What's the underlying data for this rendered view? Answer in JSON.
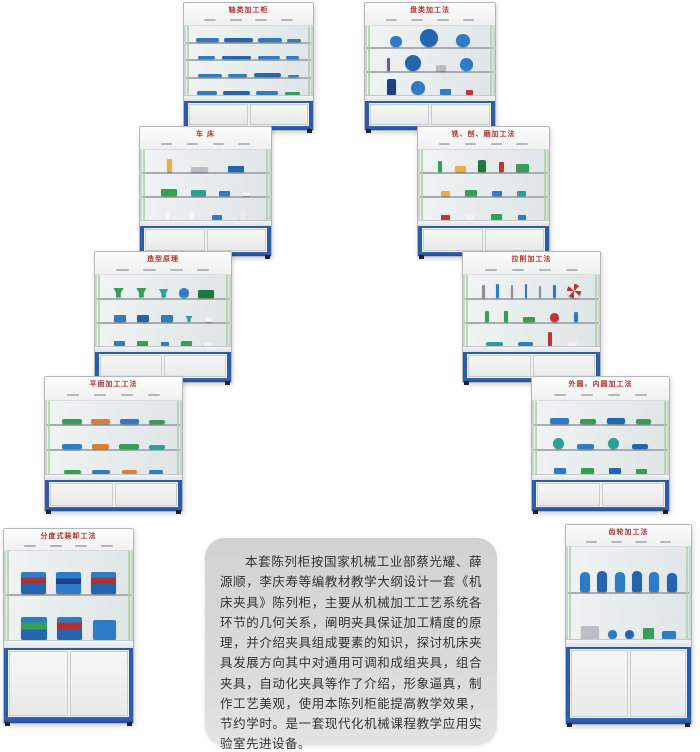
{
  "colors": {
    "frame_blue": "#2a5caa",
    "title_red": "#b23030",
    "seal_green": "#a9d3a4",
    "item_blue": "#2e7cc8",
    "item_green": "#33a055",
    "panel_gray": "#d8d8d8"
  },
  "panel": {
    "text": "本套陈列柜按国家机械工业部蔡光耀、薛源顺，李庆寿等编教材教学大纲设计一套《机床夹具》陈列柜，主要从机械加工工艺系统各环节的几何关系，阐明夹具保证加工精度的原理，并介绍夹具组成要素的知识，探讨机床夹具发展方向其中对通用可调和成组夹具，组合夹具，自动化夹具等作了介绍，形象逼真，制作工艺美观，使用本陈列柜能提高教学效果，节约学时。是一套现代化机械课程教学应用实验室先进设备。"
  },
  "cabinets": [
    {
      "name": "cabinet-shaft-machining",
      "title": "轴类加工柜",
      "x": 183,
      "y": 2,
      "w": 129,
      "h": 127,
      "hdr": 0.15,
      "cup": 0.2,
      "shelves": [
        [
          {
            "s": "shaft",
            "c": "#2e7cc8",
            "w": 20,
            "h": 22
          },
          {
            "s": "shaft",
            "c": "#2465b2",
            "w": 25,
            "h": 24
          },
          {
            "s": "shaft",
            "c": "#2e7cc8",
            "w": 21,
            "h": 22
          },
          {
            "s": "shaft",
            "c": "#2e7cc8",
            "w": 12,
            "h": 18
          }
        ],
        [
          {
            "s": "shaft",
            "c": "#2e7cc8",
            "w": 15,
            "h": 22
          },
          {
            "s": "shaft",
            "c": "#2465b2",
            "w": 25,
            "h": 24
          },
          {
            "s": "shaft",
            "c": "#2e7cc8",
            "w": 19,
            "h": 22
          },
          {
            "s": "shaft",
            "c": "#2e7cc8",
            "w": 11,
            "h": 18
          }
        ],
        [
          {
            "s": "shaft",
            "c": "#2e7cc8",
            "w": 21,
            "h": 22
          },
          {
            "s": "shaft",
            "c": "#2e7cc8",
            "w": 16,
            "h": 20
          },
          {
            "s": "shaft",
            "c": "#2465b2",
            "w": 24,
            "h": 24
          },
          {
            "s": "shaft",
            "c": "#2e7cc8",
            "w": 10,
            "h": 16
          }
        ],
        [
          {
            "s": "shaft",
            "c": "#2e7cc8",
            "w": 17,
            "h": 24
          },
          {
            "s": "shaft",
            "c": "#2465b2",
            "w": 23,
            "h": 26
          },
          {
            "s": "shaft",
            "c": "#2e7cc8",
            "w": 19,
            "h": 24
          },
          {
            "s": "shaft",
            "c": "#33a055",
            "w": 13,
            "h": 20
          }
        ]
      ]
    },
    {
      "name": "cabinet-disc-machining",
      "title": "盘类加工法",
      "x": 364,
      "y": 2,
      "w": 130,
      "h": 127,
      "hdr": 0.15,
      "cup": 0.2,
      "shelves": [
        [
          {
            "s": "disc",
            "c": "#2e7cc8",
            "w": 10,
            "h": 34
          },
          {
            "s": "disc",
            "c": "#2465b2",
            "w": 16,
            "h": 48
          },
          {
            "s": "disc",
            "c": "#2e7cc8",
            "w": 12,
            "h": 38
          }
        ],
        [
          {
            "s": "rod",
            "c": "#6a5aa8",
            "w": 3,
            "h": 62
          },
          {
            "s": "disc",
            "c": "#2465b2",
            "w": 14,
            "h": 44
          },
          {
            "s": "block",
            "c": "#b9bfc4",
            "w": 8,
            "h": 28
          },
          {
            "s": "disc",
            "c": "#2e7cc8",
            "w": 11,
            "h": 36
          }
        ],
        [
          {
            "s": "tall",
            "c": "#1f3f86",
            "w": 8,
            "h": 72
          },
          {
            "s": "disc",
            "c": "#2e7cc8",
            "w": 12,
            "h": 40
          },
          {
            "s": "block",
            "c": "#2e7cc8",
            "w": 9,
            "h": 28
          },
          {
            "s": "block",
            "c": "#c03434",
            "w": 6,
            "h": 22
          }
        ]
      ]
    },
    {
      "name": "cabinet-lathe",
      "title": "车 床",
      "x": 139,
      "y": 126,
      "w": 131,
      "h": 129,
      "hdr": 0.15,
      "cup": 0.2,
      "shelves": [
        [
          {
            "s": "rod",
            "c": "#e6b43c",
            "w": 4,
            "h": 58
          },
          {
            "s": "block",
            "c": "#b9bfc4",
            "w": 14,
            "h": 22
          },
          {
            "s": "block",
            "c": "#2465b2",
            "w": 14,
            "h": 30
          }
        ],
        [
          {
            "s": "block",
            "c": "#33a055",
            "w": 14,
            "h": 32
          },
          {
            "s": "block",
            "c": "#2aa198",
            "w": 13,
            "h": 30
          },
          {
            "s": "block",
            "c": "#2e7cc8",
            "w": 9,
            "h": 26
          },
          {
            "s": "block",
            "c": "#f2f3f4",
            "w": 6,
            "h": 18
          }
        ],
        [
          {
            "s": "bottle",
            "c": "#f2f3f4",
            "w": 6,
            "h": 44
          },
          {
            "s": "bottle",
            "c": "#f2f3f4",
            "w": 6,
            "h": 44
          },
          {
            "s": "block",
            "c": "#2e7cc8",
            "w": 9,
            "h": 24
          },
          {
            "s": "bottle",
            "c": "#e8e9ea",
            "w": 7,
            "h": 36
          }
        ]
      ]
    },
    {
      "name": "cabinet-mill-plane-grind",
      "title": "铣、刨、磨加工法",
      "x": 417,
      "y": 126,
      "w": 131,
      "h": 129,
      "hdr": 0.15,
      "cup": 0.2,
      "shelves": [
        [
          {
            "s": "rod",
            "c": "#33a055",
            "w": 4,
            "h": 52
          },
          {
            "s": "block",
            "c": "#e6b43c",
            "w": 9,
            "h": 30
          },
          {
            "s": "tall",
            "c": "#1d7a3c",
            "w": 7,
            "h": 56
          },
          {
            "s": "rod",
            "c": "#c03434",
            "w": 4,
            "h": 48
          },
          {
            "s": "block",
            "c": "#33a055",
            "w": 11,
            "h": 36
          }
        ],
        [
          {
            "s": "block",
            "c": "#e6b43c",
            "w": 8,
            "h": 26
          },
          {
            "s": "block",
            "c": "#33a055",
            "w": 10,
            "h": 30
          },
          {
            "s": "block",
            "c": "#2e7cc8",
            "w": 8,
            "h": 26
          },
          {
            "s": "block",
            "c": "#2aa198",
            "w": 8,
            "h": 24
          }
        ],
        [
          {
            "s": "block",
            "c": "#c03434",
            "w": 8,
            "h": 26
          },
          {
            "s": "block",
            "c": "#f2f3f4",
            "w": 8,
            "h": 22
          },
          {
            "s": "block",
            "c": "#33a055",
            "w": 10,
            "h": 28
          },
          {
            "s": "block",
            "c": "#2e7cc8",
            "w": 7,
            "h": 22
          }
        ]
      ]
    },
    {
      "name": "cabinet-molding-principle",
      "title": "造型原理",
      "x": 94,
      "y": 251,
      "w": 136,
      "h": 130,
      "hdr": 0.15,
      "cup": 0.2,
      "shelves": [
        [
          {
            "s": "funnel",
            "c": "#33a055",
            "w": 11,
            "h": 44
          },
          {
            "s": "funnel",
            "c": "#33a055",
            "w": 11,
            "h": 44
          },
          {
            "s": "funnel",
            "c": "#2aa198",
            "w": 10,
            "h": 38
          },
          {
            "s": "disc",
            "c": "#2e7cc8",
            "w": 8,
            "h": 30
          },
          {
            "s": "block",
            "c": "#1d7a3c",
            "w": 13,
            "h": 34
          }
        ],
        [
          {
            "s": "block",
            "c": "#2e7cc8",
            "w": 10,
            "h": 30
          },
          {
            "s": "block",
            "c": "#2465b2",
            "w": 10,
            "h": 30
          },
          {
            "s": "block",
            "c": "#2e7cc8",
            "w": 10,
            "h": 30
          },
          {
            "s": "funnel",
            "c": "#2aa198",
            "w": 8,
            "h": 28
          },
          {
            "s": "block",
            "c": "#f2f3f4",
            "w": 6,
            "h": 18
          }
        ],
        [
          {
            "s": "block",
            "c": "#2e7cc8",
            "w": 9,
            "h": 24
          },
          {
            "s": "block",
            "c": "#33a055",
            "w": 9,
            "h": 24
          },
          {
            "s": "block",
            "c": "#2e7cc8",
            "w": 7,
            "h": 20
          },
          {
            "s": "block",
            "c": "#33a055",
            "w": 9,
            "h": 24
          },
          {
            "s": "block",
            "c": "#f2f3f4",
            "w": 6,
            "h": 16
          }
        ]
      ]
    },
    {
      "name": "cabinet-broaching",
      "title": "拉削加工法",
      "x": 462,
      "y": 251,
      "w": 137,
      "h": 130,
      "hdr": 0.15,
      "cup": 0.2,
      "shelves": [
        [
          {
            "s": "rod",
            "c": "#8a9096",
            "w": 2,
            "h": 58
          },
          {
            "s": "rod",
            "c": "#2e7cc8",
            "w": 2,
            "h": 60
          },
          {
            "s": "rod",
            "c": "#8a9096",
            "w": 2,
            "h": 56
          },
          {
            "s": "rod",
            "c": "#2e7cc8",
            "w": 2,
            "h": 60
          },
          {
            "s": "rod",
            "c": "#8a9096",
            "w": 2,
            "h": 54
          },
          {
            "s": "rod",
            "c": "#2e7cc8",
            "w": 2,
            "h": 58
          },
          {
            "s": "disc",
            "c": "repeating-conic-gradient(#c03434 0 45deg,#f2f3f4 45deg 90deg)",
            "w": 11,
            "h": 40
          }
        ],
        [
          {
            "s": "rod",
            "c": "#33a055",
            "w": 3,
            "h": 50
          },
          {
            "s": "rod",
            "c": "#33a055",
            "w": 3,
            "h": 50
          },
          {
            "s": "block",
            "c": "#33a055",
            "w": 10,
            "h": 24
          },
          {
            "s": "disc",
            "c": "#c03434",
            "w": 7,
            "h": 26
          },
          {
            "s": "rod",
            "c": "#2e7cc8",
            "w": 3,
            "h": 46
          }
        ],
        [
          {
            "s": "shaft",
            "c": "#2aa198",
            "w": 14,
            "h": 20
          },
          {
            "s": "shaft",
            "c": "#2e7cc8",
            "w": 12,
            "h": 20
          },
          {
            "s": "rod",
            "c": "#c03434",
            "w": 3,
            "h": 62
          },
          {
            "s": "block",
            "c": "#f2f3f4",
            "w": 8,
            "h": 18
          }
        ]
      ]
    },
    {
      "name": "cabinet-plane-machining",
      "title": "平面加工工法",
      "x": 44,
      "y": 376,
      "w": 137,
      "h": 134,
      "hdr": 0.15,
      "cup": 0.2,
      "shelves": [
        [
          {
            "s": "shaft",
            "c": "#33a055",
            "w": 16,
            "h": 20
          },
          {
            "s": "shaft",
            "c": "#df7f2e",
            "w": 15,
            "h": 20
          },
          {
            "s": "shaft",
            "c": "#2e7cc8",
            "w": 16,
            "h": 20
          },
          {
            "s": "shaft",
            "c": "#33a055",
            "w": 13,
            "h": 18
          }
        ],
        [
          {
            "s": "shaft",
            "c": "#2e7cc8",
            "w": 16,
            "h": 20
          },
          {
            "s": "shaft",
            "c": "#df7f2e",
            "w": 14,
            "h": 20
          },
          {
            "s": "shaft",
            "c": "#33a055",
            "w": 16,
            "h": 20
          },
          {
            "s": "shaft",
            "c": "#2aa198",
            "w": 13,
            "h": 18
          }
        ],
        [
          {
            "s": "shaft",
            "c": "#33a055",
            "w": 14,
            "h": 18
          },
          {
            "s": "shaft",
            "c": "#2e7cc8",
            "w": 15,
            "h": 18
          },
          {
            "s": "shaft",
            "c": "#df7f2e",
            "w": 13,
            "h": 18
          },
          {
            "s": "shaft",
            "c": "#2e7cc8",
            "w": 12,
            "h": 16
          }
        ]
      ]
    },
    {
      "name": "cabinet-cylindrical-bore",
      "title": "外圆、内圆加工法",
      "x": 531,
      "y": 376,
      "w": 137,
      "h": 134,
      "hdr": 0.15,
      "cup": 0.2,
      "shelves": [
        [
          {
            "s": "shaft",
            "c": "#2e7cc8",
            "w": 15,
            "h": 24
          },
          {
            "s": "shaft",
            "c": "#33a055",
            "w": 13,
            "h": 22
          },
          {
            "s": "shaft",
            "c": "#2465b2",
            "w": 15,
            "h": 24
          },
          {
            "s": "shaft",
            "c": "#33a055",
            "w": 12,
            "h": 22
          }
        ],
        [
          {
            "s": "disc",
            "c": "#2aa198",
            "w": 9,
            "h": 32
          },
          {
            "s": "shaft",
            "c": "#2e7cc8",
            "w": 14,
            "h": 22
          },
          {
            "s": "disc",
            "c": "#2aa198",
            "w": 9,
            "h": 32
          },
          {
            "s": "shaft",
            "c": "#2465b2",
            "w": 13,
            "h": 22
          }
        ],
        [
          {
            "s": "block",
            "c": "#2e7cc8",
            "w": 10,
            "h": 26
          },
          {
            "s": "block",
            "c": "#33a055",
            "w": 10,
            "h": 26
          },
          {
            "s": "block",
            "c": "#2465b2",
            "w": 10,
            "h": 26
          },
          {
            "s": "block",
            "c": "#33a055",
            "w": 9,
            "h": 22
          }
        ]
      ]
    },
    {
      "name": "cabinet-indexing-fixtures",
      "title": "分度式装卸工法",
      "x": 3,
      "y": 528,
      "w": 129,
      "h": 194,
      "hdr": 0.09,
      "cup": 0.36,
      "shelves": [
        [
          {
            "s": "vise",
            "c": "linear-gradient(180deg,#2e7cc8 0 25%,#b23030 25% 55%,#2465b2 55%)",
            "w": 22,
            "h": 52
          },
          {
            "s": "vise",
            "c": "linear-gradient(180deg,#2e7cc8 0 30%,#1f3f86 30% 55%,#2e7cc8 55%)",
            "w": 22,
            "h": 50
          },
          {
            "s": "vise",
            "c": "linear-gradient(180deg,#2e7cc8 0 25%,#b23030 25% 55%,#2465b2 55%)",
            "w": 22,
            "h": 52
          }
        ],
        [
          {
            "s": "vise",
            "c": "linear-gradient(180deg,#2e7cc8 0 25%,#33a055 25% 55%,#2465b2 55%)",
            "w": 22,
            "h": 52
          },
          {
            "s": "vise",
            "c": "linear-gradient(180deg,#2e7cc8 0 25%,#b23030 25% 55%,#2465b2 55%)",
            "w": 22,
            "h": 52
          },
          {
            "s": "vise",
            "c": "#2e7cc8",
            "w": 20,
            "h": 46
          }
        ]
      ]
    },
    {
      "name": "cabinet-gear-machining",
      "title": "齿轮加工法",
      "x": 565,
      "y": 524,
      "w": 125,
      "h": 199,
      "hdr": 0.09,
      "cup": 0.36,
      "shelves": [
        [
          {
            "s": "bottle",
            "c": "#2e7cc8",
            "w": 9,
            "h": 44
          },
          {
            "s": "bottle",
            "c": "#2465b2",
            "w": 9,
            "h": 46
          },
          {
            "s": "bottle",
            "c": "#2e7cc8",
            "w": 9,
            "h": 44
          },
          {
            "s": "bottle",
            "c": "#2465b2",
            "w": 9,
            "h": 46
          },
          {
            "s": "bottle",
            "c": "#2e7cc8",
            "w": 9,
            "h": 44
          },
          {
            "s": "bottle",
            "c": "#2465b2",
            "w": 9,
            "h": 42
          }
        ],
        [
          {
            "s": "block",
            "c": "#b9bfc4",
            "w": 16,
            "h": 28
          },
          {
            "s": "disc",
            "c": "#2e7cc8",
            "w": 8,
            "h": 30
          },
          {
            "s": "disc",
            "c": "#2465b2",
            "w": 8,
            "h": 30
          },
          {
            "s": "block",
            "c": "#33a055",
            "w": 10,
            "h": 24
          },
          {
            "s": "shaft",
            "c": "#2e7cc8",
            "w": 12,
            "h": 18
          }
        ]
      ]
    }
  ]
}
